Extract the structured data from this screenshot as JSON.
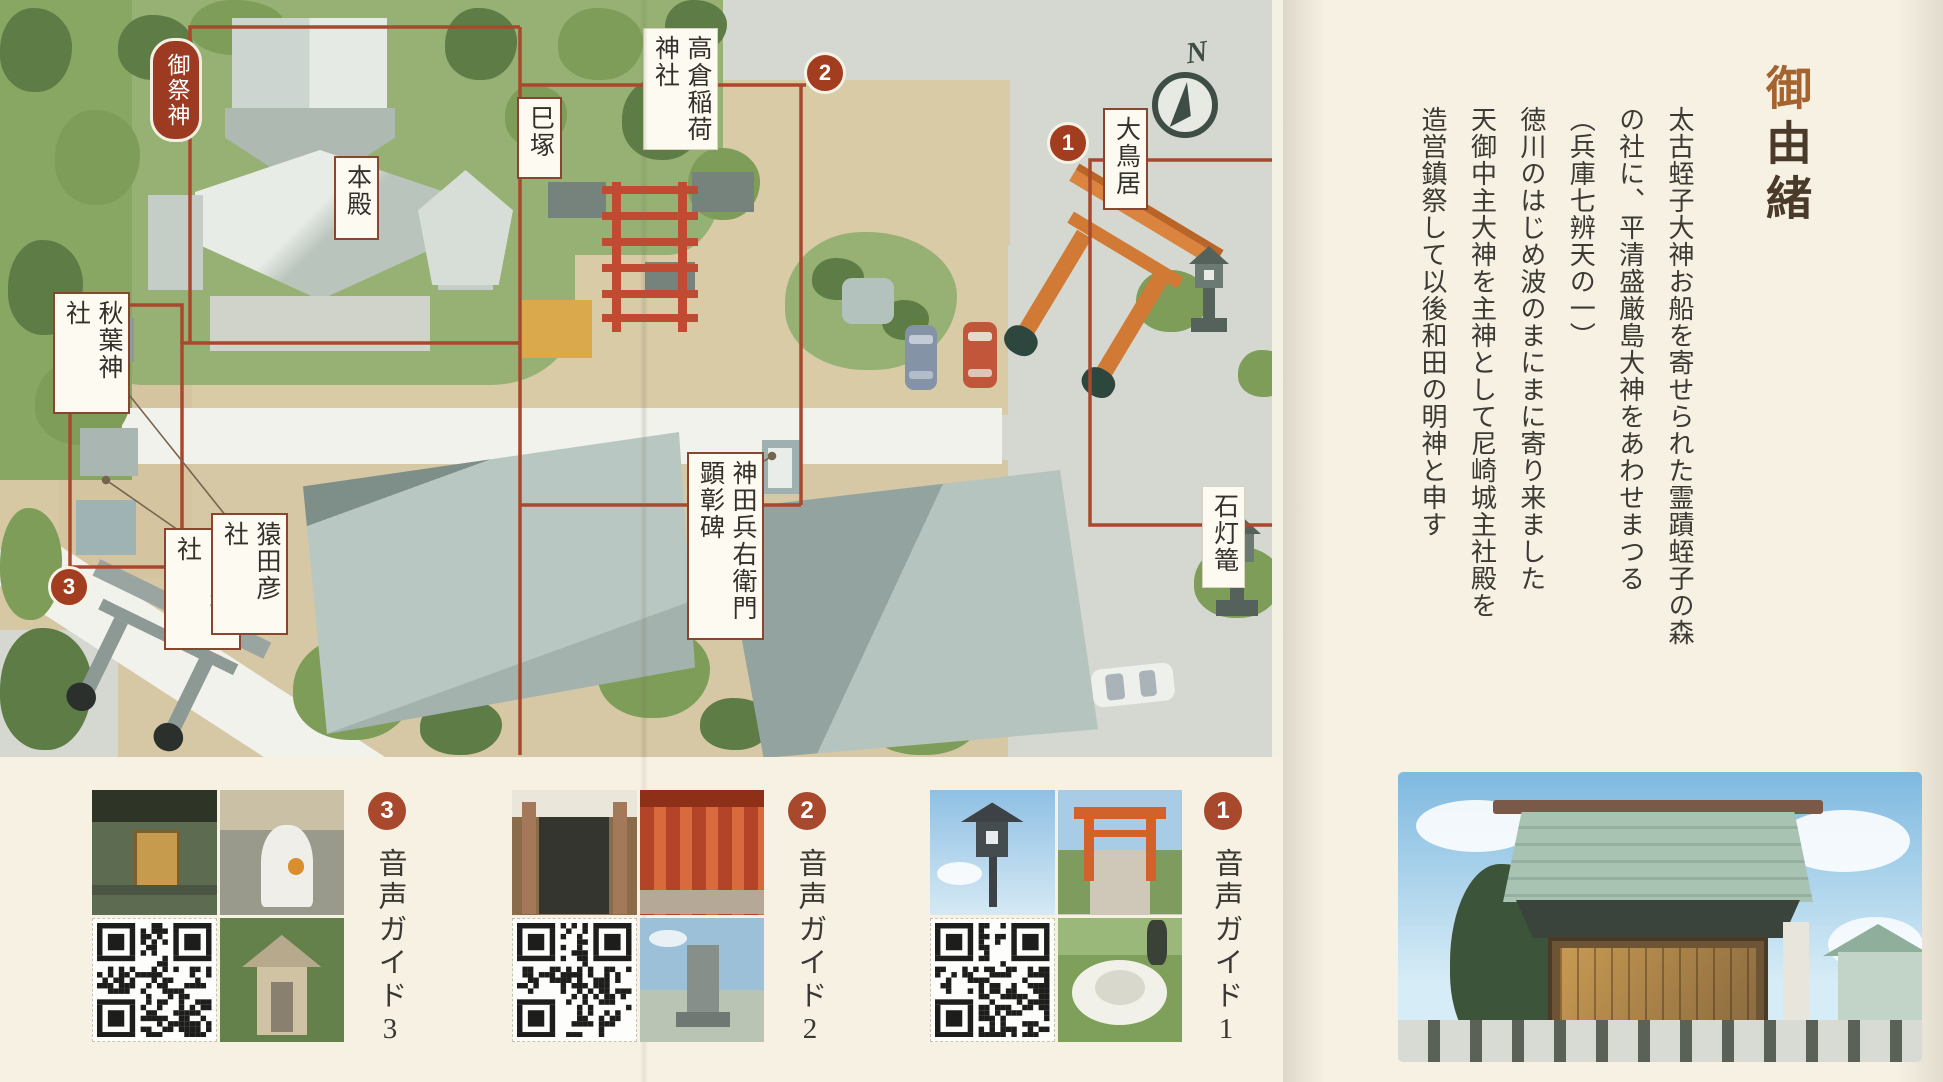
{
  "map": {
    "badge_label": "御祭神",
    "compass_label": "N",
    "labels": {
      "honden": "本殿",
      "takakura_inari": "高倉稲荷神社",
      "mizuka": "巳塚",
      "akiba_jinja": "秋葉神社",
      "miyabi_jinja": "宮比神社",
      "sarutahiko_sha": "猿田彦社",
      "kanda_kenshohi": "神田兵右衛門顕彰碑",
      "otorii": "大鳥居",
      "ishidoro": "石灯篭"
    },
    "markers": {
      "spot1": "1",
      "spot2": "2",
      "spot3": "3"
    }
  },
  "audio_guides": [
    {
      "number": "3",
      "label": "音声ガイド3"
    },
    {
      "number": "2",
      "label": "音声ガイド2"
    },
    {
      "number": "1",
      "label": "音声ガイド1"
    }
  ],
  "history": {
    "title_accent": "御",
    "title_rest": "由緒",
    "lines": [
      "太古蛭子大神お船を寄せられた霊蹟蛭子の森",
      "の社に、平清盛厳島大神をあわせまつる",
      "（兵庫七辨天の一）",
      "徳川のはじめ波のまにまに寄り来ました",
      "天御中主大神を主神として尼崎城主社殿を",
      "造営鎮祭して以後和田の明神と申す"
    ]
  },
  "colors": {
    "route_red": "#a8492e",
    "marker_red": "#a33d20",
    "badge_red": "#9c3a22",
    "page_cream": "#f6f1e3",
    "map_ground": "#d5d8d0",
    "path_tan": "#d8cba6",
    "grass_green": "#96b173",
    "torii_orange": "#d07a36"
  }
}
